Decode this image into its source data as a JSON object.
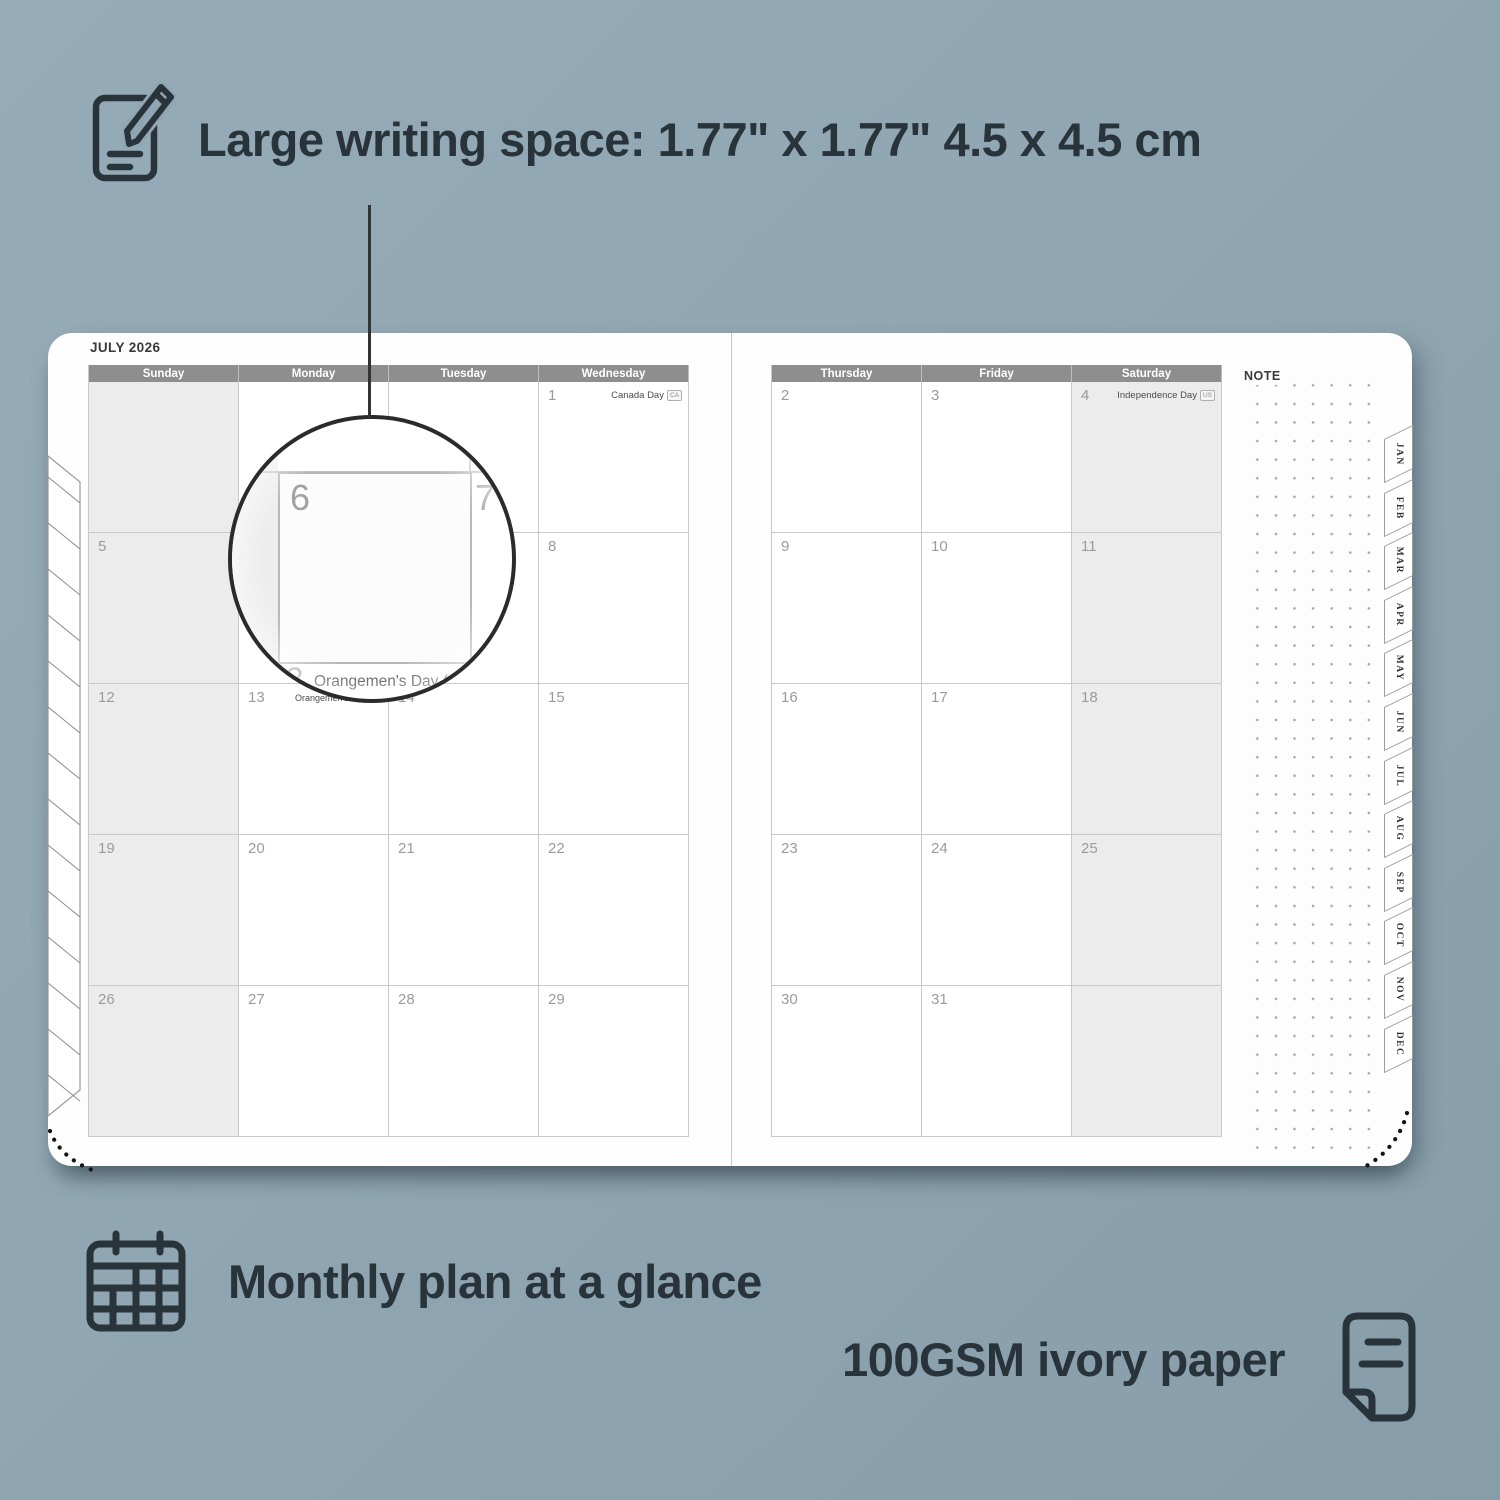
{
  "annotations": {
    "writing_space": "Large writing space: 1.77\" x 1.77\" 4.5 x 4.5 cm",
    "monthly_plan": "Monthly plan at a glance",
    "paper": "100GSM ivory paper"
  },
  "planner": {
    "month_title": "JULY 2026",
    "note_label": "NOTE",
    "left_page": {
      "day_headers": [
        "Sunday",
        "Monday",
        "Tuesday",
        "Wednesday"
      ],
      "weeks": [
        [
          "",
          "",
          "",
          "1"
        ],
        [
          "5",
          "6",
          "7",
          "8"
        ],
        [
          "12",
          "13",
          "14",
          "15"
        ],
        [
          "19",
          "20",
          "21",
          "22"
        ],
        [
          "26",
          "27",
          "28",
          "29"
        ]
      ],
      "weekend_col": 0
    },
    "right_page": {
      "day_headers": [
        "Thursday",
        "Friday",
        "Saturday"
      ],
      "weeks": [
        [
          "2",
          "3",
          "4"
        ],
        [
          "9",
          "10",
          "11"
        ],
        [
          "16",
          "17",
          "18"
        ],
        [
          "23",
          "24",
          "25"
        ],
        [
          "30",
          "31",
          ""
        ]
      ],
      "weekend_col": 2
    },
    "holidays": [
      {
        "date": "1",
        "label": "Canada Day",
        "badge": "CA",
        "truncated": false
      },
      {
        "date": "4",
        "label": "Independence Day",
        "badge": "US",
        "truncated": false
      },
      {
        "date": "13",
        "label": "Orangemen's Day (n.i.)",
        "badge": "UK",
        "truncated": true
      }
    ],
    "month_tabs": [
      "JAN",
      "FEB",
      "MAR",
      "APR",
      "MAY",
      "JUN",
      "JUL",
      "AUG",
      "SEP",
      "OCT",
      "NOV",
      "DEC"
    ]
  },
  "magnifier": {
    "day": "6",
    "adjacent_day": "7",
    "holiday_date": "13",
    "holiday_label": "Orangemen's Day (n.i.)",
    "holiday_badge": "UK"
  },
  "colors": {
    "background": "#90a6b2",
    "page": "#fdfdfd",
    "header_bar": "#8e8e8e",
    "weekend_cell": "#ececec",
    "grid_line": "#c9c9c9",
    "annotation_text": "#28333a",
    "date_text": "#9b9b9b"
  }
}
